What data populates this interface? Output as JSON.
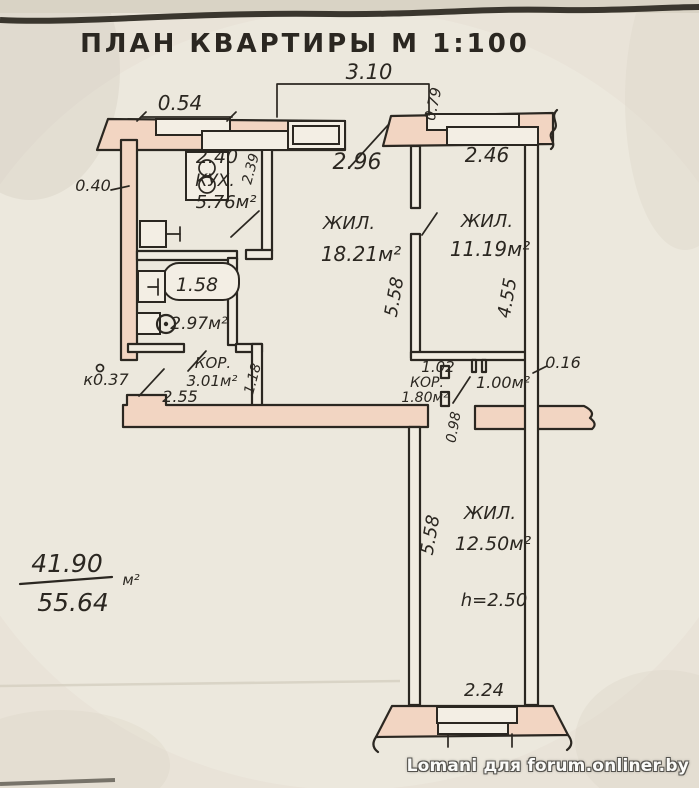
{
  "palette": {
    "paper": "#e9e3d8",
    "paper_light": "#f3eee4",
    "ink": "#2b2721",
    "wall_fill": "#f2d5c2",
    "watermark_fill": "#fbfbf9",
    "watermark_outline": "#55534e"
  },
  "watermark": "Lomani для forum.onliner.by",
  "total_area": {
    "living": "41.90",
    "total": "55.64",
    "unit": "м²"
  },
  "labels": [
    {
      "name": "plan-title",
      "text": "ПЛАН КВАРТИРЫ М 1:100",
      "x": 305,
      "y": 52,
      "size": 26,
      "bold": true,
      "italic": false,
      "spacing": 3
    },
    {
      "name": "dim-balcony-3-10",
      "text": "3.10",
      "x": 369,
      "y": 79,
      "size": 21
    },
    {
      "name": "dim-0-79",
      "text": "0.79",
      "x": 438,
      "y": 105,
      "size": 15,
      "rot": -78
    },
    {
      "name": "dim-0-54",
      "text": "0.54",
      "x": 180,
      "y": 110,
      "size": 20
    },
    {
      "name": "dim-kitchen-2-40",
      "text": "2.40",
      "x": 217,
      "y": 163,
      "size": 19
    },
    {
      "name": "dim-kitchen-2-39",
      "text": "2.39",
      "x": 255,
      "y": 170,
      "size": 14,
      "rot": -75
    },
    {
      "name": "kitchen-label",
      "text": "КУХ.",
      "x": 215,
      "y": 186,
      "size": 17
    },
    {
      "name": "kitchen-area",
      "text": "5.76м²",
      "x": 226,
      "y": 208,
      "size": 18
    },
    {
      "name": "dim-2-96",
      "text": "2.96",
      "x": 357,
      "y": 169,
      "size": 22
    },
    {
      "name": "dim-2-46",
      "text": "2.46",
      "x": 487,
      "y": 162,
      "size": 20
    },
    {
      "name": "dim-0-40",
      "text": "0.40",
      "x": 93,
      "y": 191,
      "size": 16
    },
    {
      "name": "living1-label",
      "text": "ЖИЛ.",
      "x": 349,
      "y": 229,
      "size": 18
    },
    {
      "name": "living1-area",
      "text": "18.21м²",
      "x": 361,
      "y": 261,
      "size": 20
    },
    {
      "name": "living2-label",
      "text": "ЖИЛ.",
      "x": 487,
      "y": 227,
      "size": 18
    },
    {
      "name": "living2-area",
      "text": "11.19м²",
      "x": 490,
      "y": 256,
      "size": 20
    },
    {
      "name": "dim-5-58-upper",
      "text": "5.58",
      "x": 400,
      "y": 298,
      "size": 18,
      "rot": -80
    },
    {
      "name": "dim-4-55",
      "text": "4.55",
      "x": 513,
      "y": 299,
      "size": 18,
      "rot": -80
    },
    {
      "name": "bathtub-dim-1-58",
      "text": "1.58",
      "x": 197,
      "y": 291,
      "size": 19
    },
    {
      "name": "bathroom-area",
      "text": "2.97м²",
      "x": 199,
      "y": 329,
      "size": 17
    },
    {
      "name": "hall-label",
      "text": "КОР.",
      "x": 213,
      "y": 368,
      "size": 15
    },
    {
      "name": "hall-area",
      "text": "3.01м²",
      "x": 212,
      "y": 386,
      "size": 15
    },
    {
      "name": "dim-1-18",
      "text": "1.18",
      "x": 257,
      "y": 380,
      "size": 14,
      "rot": -75
    },
    {
      "name": "entry-mark-0-37",
      "text": "к0.37",
      "x": 106,
      "y": 385,
      "size": 16
    },
    {
      "name": "dim-2-55",
      "text": "2.55",
      "x": 180,
      "y": 402,
      "size": 16
    },
    {
      "name": "dim-1-02",
      "text": "1.02",
      "x": 438,
      "y": 372,
      "size": 15
    },
    {
      "name": "corridor-label",
      "text": "КОР.",
      "x": 427,
      "y": 387,
      "size": 14
    },
    {
      "name": "corridor-area",
      "text": "1.80м²",
      "x": 425,
      "y": 402,
      "size": 14
    },
    {
      "name": "closet-area",
      "text": "1.00м²",
      "x": 503,
      "y": 388,
      "size": 16
    },
    {
      "name": "dim-0-16",
      "text": "0.16",
      "x": 563,
      "y": 368,
      "size": 16
    },
    {
      "name": "dim-0-98",
      "text": "0.98",
      "x": 458,
      "y": 428,
      "size": 14,
      "rot": -80
    },
    {
      "name": "dim-5-58-lower",
      "text": "5.58",
      "x": 436,
      "y": 536,
      "size": 18,
      "rot": -80
    },
    {
      "name": "living3-label",
      "text": "ЖИЛ.",
      "x": 490,
      "y": 519,
      "size": 18
    },
    {
      "name": "living3-area",
      "text": "12.50м²",
      "x": 493,
      "y": 550,
      "size": 19
    },
    {
      "name": "ceiling-height",
      "text": "h=2.50",
      "x": 494,
      "y": 606,
      "size": 18
    },
    {
      "name": "dim-2-24",
      "text": "2.24",
      "x": 484,
      "y": 696,
      "size": 18
    },
    {
      "name": "total-living-area",
      "text": "41.90",
      "x": 67,
      "y": 572,
      "size": 25
    },
    {
      "name": "total-area",
      "text": "55.64",
      "x": 73,
      "y": 611,
      "size": 25
    },
    {
      "name": "area-unit",
      "text": "м²",
      "x": 131,
      "y": 585,
      "size": 15
    }
  ]
}
